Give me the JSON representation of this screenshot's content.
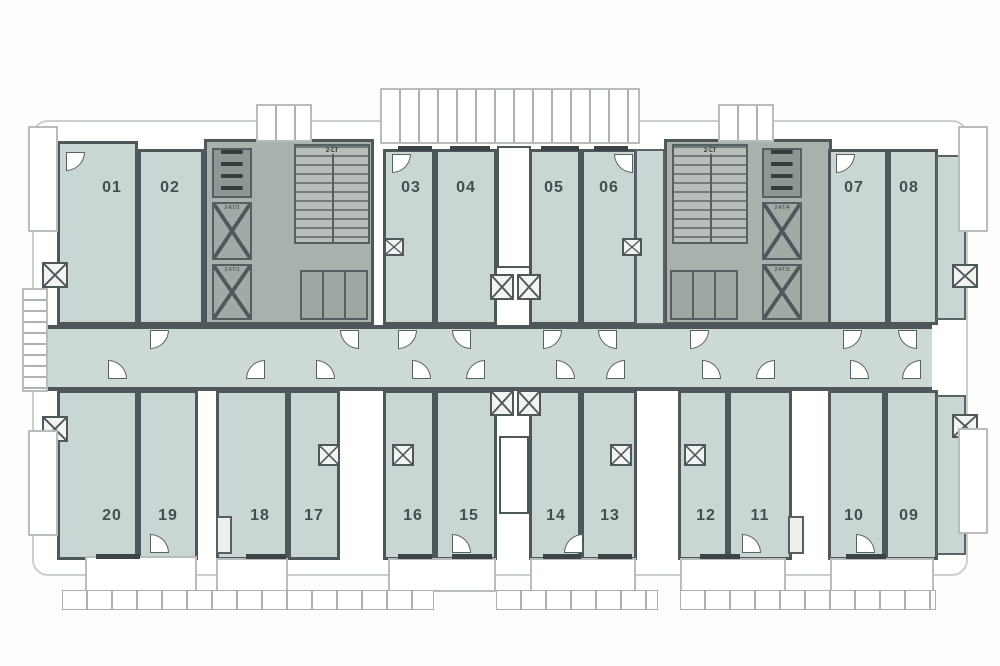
{
  "plan": {
    "type": "residential-floor-plan",
    "unit_count": 20,
    "colors": {
      "unit_fill": "#c9d6d3",
      "corridor_fill": "#cdd9d6",
      "core_fill": "#a9b1af",
      "wall": "#4e585a",
      "label_text": "#454e50"
    }
  },
  "units": [
    {
      "no": "01",
      "x": 57,
      "y": 141,
      "w": 81,
      "h": 184,
      "lx": 112,
      "ly": 188
    },
    {
      "no": "02",
      "x": 138,
      "y": 149,
      "w": 66,
      "h": 176,
      "lx": 170,
      "ly": 188
    },
    {
      "no": "03",
      "x": 383,
      "y": 149,
      "w": 52,
      "h": 176,
      "lx": 411,
      "ly": 188
    },
    {
      "no": "04",
      "x": 435,
      "y": 149,
      "w": 62,
      "h": 176,
      "lx": 466,
      "ly": 188
    },
    {
      "no": "05",
      "x": 529,
      "y": 149,
      "w": 52,
      "h": 176,
      "lx": 554,
      "ly": 188
    },
    {
      "no": "06",
      "x": 581,
      "y": 149,
      "w": 56,
      "h": 176,
      "lx": 609,
      "ly": 188
    },
    {
      "no": "07",
      "x": 828,
      "y": 149,
      "w": 60,
      "h": 176,
      "lx": 854,
      "ly": 188
    },
    {
      "no": "08",
      "x": 888,
      "y": 149,
      "w": 50,
      "h": 176,
      "lx": 909,
      "ly": 188
    },
    {
      "no": "09",
      "x": 885,
      "y": 390,
      "w": 53,
      "h": 170,
      "lx": 909,
      "ly": 516
    },
    {
      "no": "10",
      "x": 828,
      "y": 390,
      "w": 57,
      "h": 170,
      "lx": 854,
      "ly": 516
    },
    {
      "no": "11",
      "x": 728,
      "y": 390,
      "w": 64,
      "h": 170,
      "lx": 760,
      "ly": 516
    },
    {
      "no": "12",
      "x": 678,
      "y": 390,
      "w": 50,
      "h": 170,
      "lx": 706,
      "ly": 516
    },
    {
      "no": "13",
      "x": 581,
      "y": 390,
      "w": 56,
      "h": 170,
      "lx": 610,
      "ly": 516
    },
    {
      "no": "14",
      "x": 529,
      "y": 390,
      "w": 52,
      "h": 170,
      "lx": 556,
      "ly": 516
    },
    {
      "no": "15",
      "x": 435,
      "y": 390,
      "w": 62,
      "h": 170,
      "lx": 469,
      "ly": 516
    },
    {
      "no": "16",
      "x": 383,
      "y": 390,
      "w": 52,
      "h": 170,
      "lx": 413,
      "ly": 516
    },
    {
      "no": "17",
      "x": 288,
      "y": 390,
      "w": 52,
      "h": 170,
      "lx": 314,
      "ly": 516
    },
    {
      "no": "18",
      "x": 216,
      "y": 390,
      "w": 72,
      "h": 170,
      "lx": 260,
      "ly": 516
    },
    {
      "no": "19",
      "x": 138,
      "y": 390,
      "w": 60,
      "h": 170,
      "lx": 168,
      "ly": 516
    },
    {
      "no": "20",
      "x": 57,
      "y": 390,
      "w": 81,
      "h": 170,
      "lx": 112,
      "ly": 516
    }
  ],
  "fillers": [
    {
      "x": 635,
      "y": 149,
      "w": 30,
      "h": 176
    },
    {
      "x": 936,
      "y": 155,
      "w": 30,
      "h": 165
    },
    {
      "x": 936,
      "y": 395,
      "w": 30,
      "h": 160
    }
  ],
  "slab": {
    "x": 32,
    "y": 120,
    "w": 936,
    "h": 456
  },
  "corridor": {
    "x": 38,
    "y": 325,
    "w": 894,
    "h": 66
  },
  "cores": [
    {
      "x": 204,
      "y": 139,
      "w": 170,
      "h": 186
    },
    {
      "x": 664,
      "y": 139,
      "w": 168,
      "h": 186
    }
  ],
  "stairs": [
    {
      "x": 294,
      "y": 144,
      "w": 76,
      "h": 100,
      "label": "2-LT"
    },
    {
      "x": 672,
      "y": 144,
      "w": 76,
      "h": 100,
      "label": "2-LT"
    }
  ],
  "elevators": [
    {
      "x": 212,
      "y": 202,
      "w": 40,
      "h": 58,
      "label": "2-KT/2"
    },
    {
      "x": 212,
      "y": 264,
      "w": 40,
      "h": 56,
      "label": "2-KT/1"
    },
    {
      "x": 762,
      "y": 202,
      "w": 40,
      "h": 58,
      "label": "2-KT/4"
    },
    {
      "x": 762,
      "y": 264,
      "w": 40,
      "h": 56,
      "label": "2-KT/3"
    }
  ],
  "equip_shafts": [
    {
      "x": 212,
      "y": 148,
      "w": 40,
      "h": 50
    },
    {
      "x": 762,
      "y": 148,
      "w": 40,
      "h": 50
    }
  ],
  "core_lower_rooms": [
    {
      "x": 300,
      "y": 270,
      "w": 68,
      "h": 50
    },
    {
      "x": 670,
      "y": 270,
      "w": 68,
      "h": 50
    }
  ],
  "lightwells": [
    {
      "x": 497,
      "y": 146,
      "w": 34,
      "h": 122
    },
    {
      "x": 499,
      "y": 436,
      "w": 30,
      "h": 78
    }
  ],
  "wash_squares": [
    {
      "x": 42,
      "y": 262,
      "w": 26,
      "h": 26
    },
    {
      "x": 42,
      "y": 416,
      "w": 26,
      "h": 26
    },
    {
      "x": 952,
      "y": 264,
      "w": 26,
      "h": 24
    },
    {
      "x": 952,
      "y": 414,
      "w": 26,
      "h": 24
    },
    {
      "x": 384,
      "y": 238,
      "w": 20,
      "h": 18
    },
    {
      "x": 622,
      "y": 238,
      "w": 20,
      "h": 18
    },
    {
      "x": 490,
      "y": 274,
      "w": 24,
      "h": 26
    },
    {
      "x": 517,
      "y": 274,
      "w": 24,
      "h": 26
    },
    {
      "x": 490,
      "y": 390,
      "w": 24,
      "h": 26
    },
    {
      "x": 517,
      "y": 390,
      "w": 24,
      "h": 26
    },
    {
      "x": 318,
      "y": 444,
      "w": 22,
      "h": 22
    },
    {
      "x": 392,
      "y": 444,
      "w": 22,
      "h": 22
    },
    {
      "x": 610,
      "y": 444,
      "w": 22,
      "h": 22
    },
    {
      "x": 684,
      "y": 444,
      "w": 22,
      "h": 22
    }
  ],
  "gap_boxes": [
    {
      "x": 216,
      "y": 516,
      "w": 16,
      "h": 38
    },
    {
      "x": 788,
      "y": 516,
      "w": 16,
      "h": 38
    }
  ],
  "balconies": [
    {
      "x": 380,
      "y": 88,
      "w": 260,
      "h": 56,
      "ticks": "v"
    },
    {
      "x": 256,
      "y": 104,
      "w": 56,
      "h": 38,
      "ticks": "v"
    },
    {
      "x": 718,
      "y": 104,
      "w": 56,
      "h": 38,
      "ticks": "v"
    },
    {
      "x": 28,
      "y": 126,
      "w": 30,
      "h": 106,
      "ticks": ""
    },
    {
      "x": 28,
      "y": 430,
      "w": 30,
      "h": 106,
      "ticks": ""
    },
    {
      "x": 22,
      "y": 288,
      "w": 26,
      "h": 104,
      "ticks": "h"
    },
    {
      "x": 958,
      "y": 126,
      "w": 30,
      "h": 106,
      "ticks": ""
    },
    {
      "x": 958,
      "y": 428,
      "w": 30,
      "h": 106,
      "ticks": ""
    },
    {
      "x": 85,
      "y": 556,
      "w": 112,
      "h": 36,
      "ticks": ""
    },
    {
      "x": 216,
      "y": 558,
      "w": 72,
      "h": 34,
      "ticks": ""
    },
    {
      "x": 388,
      "y": 558,
      "w": 108,
      "h": 34,
      "ticks": ""
    },
    {
      "x": 530,
      "y": 558,
      "w": 106,
      "h": 34,
      "ticks": ""
    },
    {
      "x": 680,
      "y": 558,
      "w": 106,
      "h": 34,
      "ticks": ""
    },
    {
      "x": 830,
      "y": 558,
      "w": 104,
      "h": 34,
      "ticks": ""
    }
  ],
  "railings": [
    {
      "x": 62,
      "y": 590,
      "w": 372,
      "h": 20
    },
    {
      "x": 496,
      "y": 590,
      "w": 162,
      "h": 20
    },
    {
      "x": 680,
      "y": 590,
      "w": 256,
      "h": 20
    }
  ],
  "doors": [
    {
      "x": 150,
      "y": 330,
      "d": "br"
    },
    {
      "x": 340,
      "y": 330,
      "d": "bl"
    },
    {
      "x": 398,
      "y": 330,
      "d": "br"
    },
    {
      "x": 452,
      "y": 330,
      "d": "bl"
    },
    {
      "x": 543,
      "y": 330,
      "d": "br"
    },
    {
      "x": 598,
      "y": 330,
      "d": "bl"
    },
    {
      "x": 690,
      "y": 330,
      "d": "br"
    },
    {
      "x": 843,
      "y": 330,
      "d": "br"
    },
    {
      "x": 898,
      "y": 330,
      "d": "bl"
    },
    {
      "x": 108,
      "y": 360,
      "d": "tr"
    },
    {
      "x": 246,
      "y": 360,
      "d": "tl"
    },
    {
      "x": 316,
      "y": 360,
      "d": "tr"
    },
    {
      "x": 412,
      "y": 360,
      "d": "tr"
    },
    {
      "x": 466,
      "y": 360,
      "d": "tl"
    },
    {
      "x": 556,
      "y": 360,
      "d": "tr"
    },
    {
      "x": 606,
      "y": 360,
      "d": "tl"
    },
    {
      "x": 702,
      "y": 360,
      "d": "tr"
    },
    {
      "x": 756,
      "y": 360,
      "d": "tl"
    },
    {
      "x": 850,
      "y": 360,
      "d": "tr"
    },
    {
      "x": 902,
      "y": 360,
      "d": "tl"
    },
    {
      "x": 66,
      "y": 152,
      "d": "br"
    },
    {
      "x": 392,
      "y": 154,
      "d": "br"
    },
    {
      "x": 614,
      "y": 154,
      "d": "bl"
    },
    {
      "x": 836,
      "y": 154,
      "d": "br"
    },
    {
      "x": 150,
      "y": 534,
      "d": "tr"
    },
    {
      "x": 452,
      "y": 534,
      "d": "tr"
    },
    {
      "x": 564,
      "y": 534,
      "d": "tl"
    },
    {
      "x": 742,
      "y": 534,
      "d": "tr"
    },
    {
      "x": 856,
      "y": 534,
      "d": "tr"
    }
  ],
  "windows": [
    {
      "x": 398,
      "y": 146,
      "w": 34
    },
    {
      "x": 450,
      "y": 146,
      "w": 40
    },
    {
      "x": 541,
      "y": 146,
      "w": 38
    },
    {
      "x": 594,
      "y": 146,
      "w": 34
    },
    {
      "x": 96,
      "y": 554,
      "w": 44
    },
    {
      "x": 246,
      "y": 554,
      "w": 40
    },
    {
      "x": 398,
      "y": 554,
      "w": 34
    },
    {
      "x": 452,
      "y": 554,
      "w": 40
    },
    {
      "x": 543,
      "y": 554,
      "w": 38
    },
    {
      "x": 598,
      "y": 554,
      "w": 34
    },
    {
      "x": 700,
      "y": 554,
      "w": 40
    },
    {
      "x": 846,
      "y": 554,
      "w": 40
    }
  ]
}
